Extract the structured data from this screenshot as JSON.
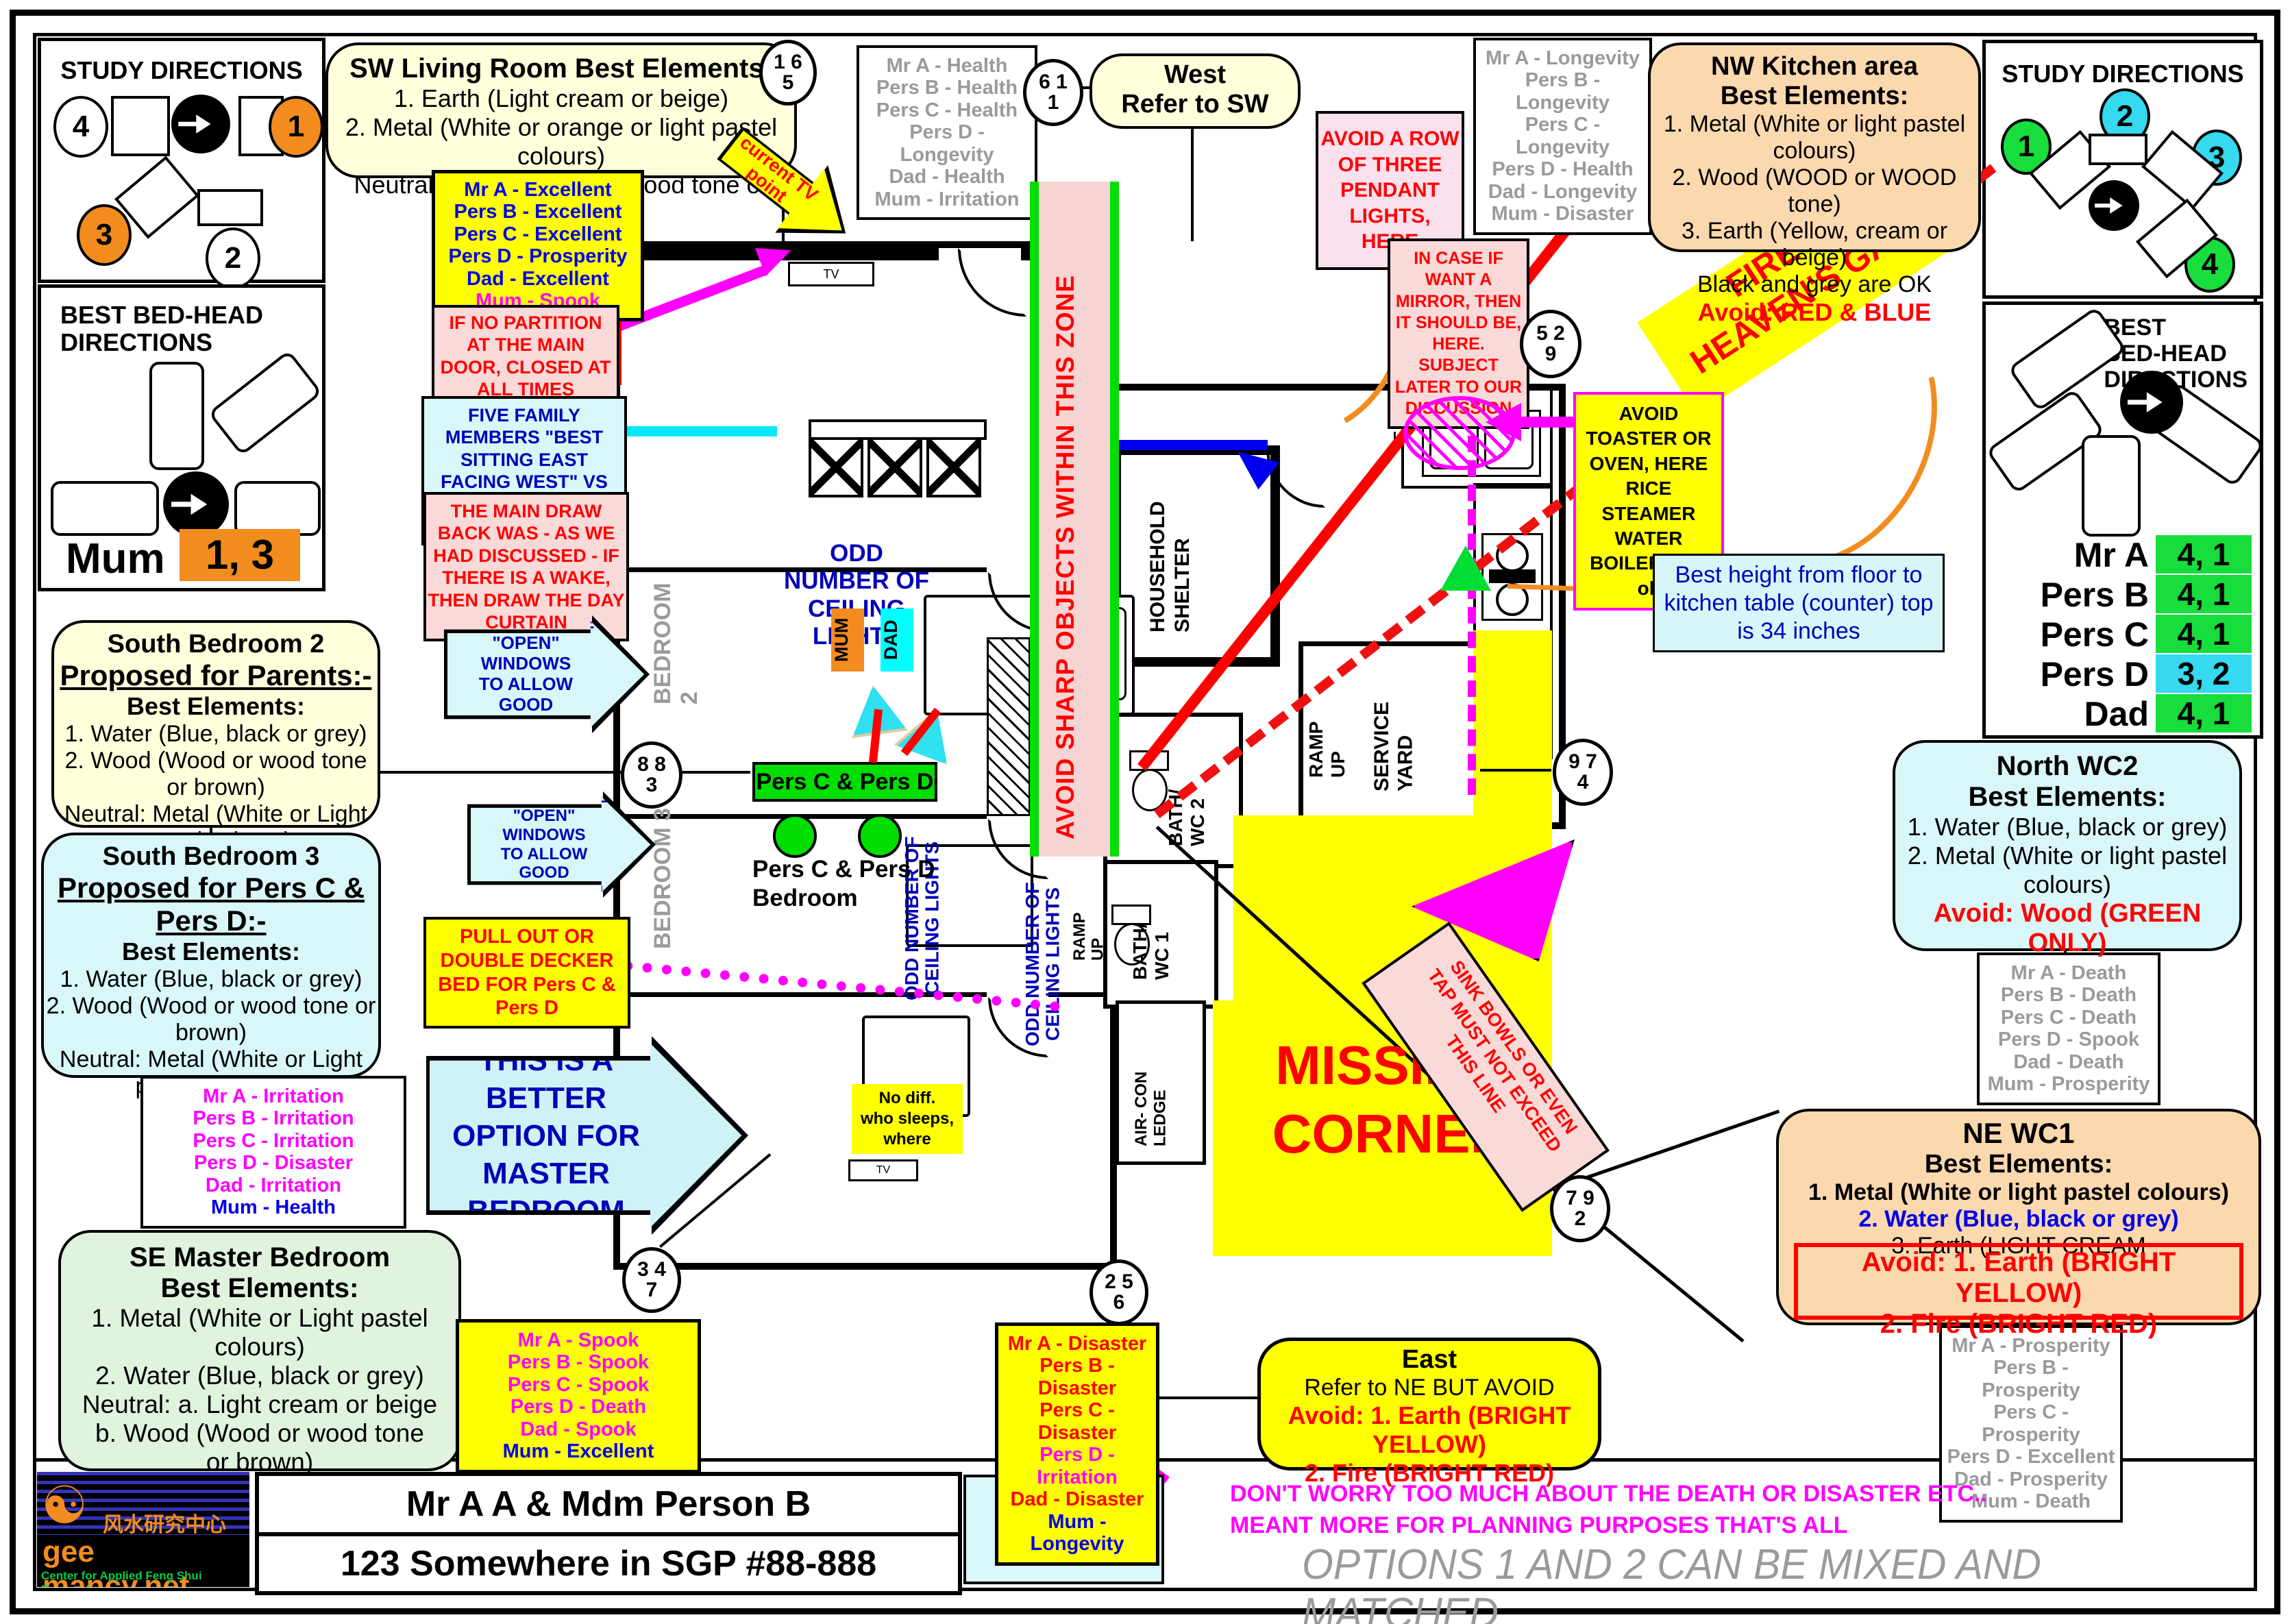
{
  "accent_colors": {
    "cream": "#FFFFDC",
    "peach": "#FBD8AE",
    "cyanbox": "#D9F6F8",
    "green_note": "#DFF3DF",
    "yellow": "#FFFF00",
    "pink": "#FAD9D9",
    "bright_green": "#00DE00",
    "orange": "#F28C1E",
    "cyan": "#35D9F0"
  },
  "panels": {
    "study_left": {
      "title": "STUDY DIRECTIONS",
      "n1": "1",
      "n2": "2",
      "n3": "3",
      "n4": "4"
    },
    "bedhead_left": {
      "title": "BEST BED-HEAD\nDIRECTIONS",
      "person": "Mum",
      "value": "1, 3"
    },
    "study_right": {
      "title": "STUDY DIRECTIONS",
      "n1": "1",
      "n2": "2",
      "n3": "3",
      "n4": "4"
    },
    "bedhead_right": {
      "title": "BEST\nBED-HEAD\nDIRECTIONS",
      "rows": [
        {
          "name": "Mr A",
          "val": "4, 1"
        },
        {
          "name": "Pers B",
          "val": "4, 1"
        },
        {
          "name": "Pers C",
          "val": "4, 1"
        },
        {
          "name": "Pers D",
          "val": "3, 2"
        },
        {
          "name": "Dad",
          "val": "4, 1"
        }
      ]
    }
  },
  "boxes": {
    "sw_living": {
      "title": "SW Living Room Best Elements:",
      "l1": "1. Earth (Light cream or beige)",
      "l2": "2. Metal (White or orange or light pastel colours)",
      "l3": "Neutral: Wood (Wood or wood tone or brown)"
    },
    "west": {
      "l1": "West",
      "l2": "Refer to SW"
    },
    "nw_kitchen": {
      "title": "NW Kitchen area",
      "sub": "Best Elements:",
      "l1": "1. Metal (White or light pastel colours)",
      "l2": "2. Wood (WOOD or WOOD tone)",
      "l3": "3. Earth (Yellow, cream or beige)",
      "l4": "Black and grey are OK",
      "avoid": "Avoid: RED & BLUE"
    },
    "south_b2": {
      "title": "South Bedroom 2",
      "sub": "Proposed for Parents:-",
      "be": "Best Elements:",
      "l1": "1. Water (Blue, black or grey)",
      "l2": "2. Wood (Wood or wood tone or brown)",
      "l3": "Neutral: Metal (White or Light pastel colours)"
    },
    "south_b3": {
      "title": "South Bedroom 3",
      "sub": "Proposed for Pers C & Pers D:-",
      "be": "Best Elements:",
      "l1": "1. Water (Blue, black or grey)",
      "l2": "2. Wood (Wood or wood tone or brown)",
      "l3": "Neutral: Metal (White or Light pastel colours)"
    },
    "se_master": {
      "title": "SE Master Bedroom",
      "sub": "Best Elements:",
      "l1": "1. Metal (White or Light pastel colours)",
      "l2": "2. Water (Blue, black or grey)",
      "l3": "Neutral: a. Light cream or beige b. Wood (Wood or wood tone or brown)"
    },
    "north_wc2": {
      "title": "North WC2",
      "sub": "Best Elements:",
      "l1": "1. Water (Blue, black or grey)",
      "l2": "2. Metal (White or light pastel colours)",
      "avoid": "Avoid: Wood (GREEN ONLY)"
    },
    "ne_wc1": {
      "title": "NE  WC1",
      "sub": "Best Elements:",
      "l1": "1. Metal (White or light pastel colours)",
      "l2": "2. Water (Blue, black or grey)",
      "l3": "3. Earth (LIGHT CREAM",
      "avoid1": "Avoid: 1. Earth (BRIGHT YELLOW)",
      "avoid2": "2. Fire (BRIGHT RED)"
    },
    "east": {
      "title": "East",
      "l1": "Refer to NE BUT AVOID",
      "avoid1": "Avoid: 1. Earth (BRIGHT YELLOW)",
      "avoid2": "2. Fire (BRIGHT RED)"
    }
  },
  "notes": {
    "current_tv": "current TV\npoint",
    "if_no_partition": "IF NO PARTITION AT THE MAIN DOOR, CLOSED AT ALL TIMES",
    "five_family": "FIVE FAMILY MEMBERS \"BEST SITTING EAST FACING WEST\" VS ONLY MUM FACING EAST",
    "main_drawback": "THE MAIN DRAW BACK WAS - AS WE HAD DISCUSSED - IF THERE IS A WAKE, THEN DRAW THE DAY CURTAIN",
    "avoid_row": "AVOID A ROW OF THREE PENDANT LIGHTS, HERE",
    "in_case_mirror": "IN CASE IF WANT A MIRROR, THEN IT SHOULD BE, HERE. SUBJECT LATER TO OUR DISCUSSION",
    "avoid_toaster": "AVOID TOASTER OR OVEN, HERE RICE STEAMER WATER BOILER ARE ok",
    "best_height": "Best height from floor to kitchen table (counter) top is 34 inches",
    "fire_gate": "FIRE AT\nHEAVEN'S GATE",
    "pull_out": "PULL OUT OR DOUBLE DECKER BED FOR Pers C & Pers D",
    "good_qi": "GOOD TO HAVE\n\"OPEN\" WINDOWS\nTO ALLOW GOOD\nQI TO FLOW IN",
    "better_option": "THIS IS A BETTER\nOPTION FOR\nMASTER\nBEDROOM",
    "no_diff": "No diff.\nwho sleeps,\nwhere",
    "avoid_sharp": "AVOID SHARP OBJECTS WITHIN THIS ZONE",
    "missing_corner": "MISSING\nCORNER",
    "sink_bowls": "SINK BOWLS OR EVEN\nTAP MUST NOT EXCEED\nTHIS LINE",
    "odd_lights": "ODD\nNUMBER OF CEILING\nLIGHTS",
    "odd_lights_side": "ODD NUMBER OF CEILING LIGHTS",
    "dont_worry": "DON'T WORRY TOO MUCH ABOUT THE DEATH OR DISASTER ETC.. MEANT MORE FOR PLANNING PURPOSES THAT'S ALL",
    "options_note": "OPTIONS 1 AND 2 CAN BE MIXED AND MATCHED"
  },
  "lists": {
    "living": [
      {
        "t": "Mr A -  Excellent",
        "c": "tblue"
      },
      {
        "t": "Pers B -  Excellent",
        "c": "tblue"
      },
      {
        "t": "Pers C -  Excellent",
        "c": "tblue"
      },
      {
        "t": "Pers D -  Prosperity",
        "c": "tblue"
      },
      {
        "t": "Dad -  Excellent",
        "c": "tblue"
      },
      {
        "t": "Mum -  Spook",
        "c": "tmag"
      }
    ],
    "west": [
      {
        "t": "Mr A -  Health",
        "c": "tgray"
      },
      {
        "t": "Pers B -  Health",
        "c": "tgray"
      },
      {
        "t": "Pers C -  Health",
        "c": "tgray"
      },
      {
        "t": "Pers D -  Longevity",
        "c": "tgray"
      },
      {
        "t": "Dad -  Health",
        "c": "tgray"
      },
      {
        "t": "Mum -  Irritation",
        "c": "tgray"
      }
    ],
    "nw": [
      {
        "t": "Mr A -  Longevity",
        "c": "tgray"
      },
      {
        "t": "Pers B -  Longevity",
        "c": "tgray"
      },
      {
        "t": "Pers C -  Longevity",
        "c": "tgray"
      },
      {
        "t": "Pers D -  Health",
        "c": "tgray"
      },
      {
        "t": "Dad -  Longevity",
        "c": "tgray"
      },
      {
        "t": "Mum -  Disaster",
        "c": "tgray"
      }
    ],
    "se_irr": [
      {
        "t": "Mr A -  Irritation",
        "c": "tmag"
      },
      {
        "t": "Pers B -  Irritation",
        "c": "tmag"
      },
      {
        "t": "Pers C -  Irritation",
        "c": "tmag"
      },
      {
        "t": "Pers D -  Disaster",
        "c": "tmag"
      },
      {
        "t": "Dad -  Irritation",
        "c": "tmag"
      },
      {
        "t": "Mum -  Health",
        "c": "tblue"
      }
    ],
    "se_spook": [
      {
        "t": "Mr A -  Spook",
        "c": "tmag"
      },
      {
        "t": "Pers B -  Spook",
        "c": "tmag"
      },
      {
        "t": "Pers C -  Spook",
        "c": "tmag"
      },
      {
        "t": "Pers D -  Death",
        "c": "tmag"
      },
      {
        "t": "Dad -  Spook",
        "c": "tmag"
      },
      {
        "t": "Mum -  Excellent",
        "c": "tblue"
      }
    ],
    "north": [
      {
        "t": "Mr A -  Death",
        "c": "tgray"
      },
      {
        "t": "Pers B -  Death",
        "c": "tgray"
      },
      {
        "t": "Pers C -  Death",
        "c": "tgray"
      },
      {
        "t": "Pers D -  Spook",
        "c": "tgray"
      },
      {
        "t": "Dad -  Death",
        "c": "tgray"
      },
      {
        "t": "Mum -  Prosperity",
        "c": "tgray"
      }
    ],
    "ne": [
      {
        "t": "Mr A -  Prosperity",
        "c": "tgray"
      },
      {
        "t": "Pers B -  Prosperity",
        "c": "tgray"
      },
      {
        "t": "Pers C -  Prosperity",
        "c": "tgray"
      },
      {
        "t": "Pers D -  Excellent",
        "c": "tgray"
      },
      {
        "t": "Dad -  Prosperity",
        "c": "tgray"
      },
      {
        "t": "Mum -  Death",
        "c": "tgray"
      }
    ],
    "east": [
      {
        "t": "Mr A -  Disaster",
        "c": "tred"
      },
      {
        "t": "Pers B -  Disaster",
        "c": "tred"
      },
      {
        "t": "Pers C -  Disaster",
        "c": "tred"
      },
      {
        "t": "Pers D -  Irritation",
        "c": "tmag"
      },
      {
        "t": "Dad -  Disaster",
        "c": "tred"
      },
      {
        "t": "Mum -  Longevity",
        "c": "tblue"
      }
    ]
  },
  "circles": {
    "c165": {
      "a": "1 6",
      "b": "5"
    },
    "c611": {
      "a": "6 1",
      "b": "1"
    },
    "c529": {
      "a": "5 2",
      "b": "9"
    },
    "c883": {
      "a": "8 8",
      "b": "3"
    },
    "c974": {
      "a": "9 7",
      "b": "4"
    },
    "c347": {
      "a": "3 4",
      "b": "7"
    },
    "c256": {
      "a": "2 5",
      "b": "6"
    },
    "c792": {
      "a": "7 9",
      "b": "2"
    }
  },
  "plan": {
    "bedroom2": "BEDROOM 2",
    "bedroom3": "BEDROOM 3",
    "shelter": "HOUSEHOLD\nSHELTER",
    "bath2": "BATH/\nWC 2",
    "bath1": "BATH/\nWC 1",
    "ramp": "RAMP\nUP",
    "ramp2": "RAMP\nUP",
    "service": "SERVICE\nYARD",
    "aircon": "AIR- CON\nLEDGE",
    "mum": "MUM",
    "dad": "DAD",
    "pers_cd": "Pers C & Pers D",
    "pers_cd_bedroom": "Pers C & Pers D\nBedroom",
    "tv": "TV",
    "f": "F"
  },
  "footer": {
    "name": "Mr A A & Mdm Person B",
    "address": "123 Somewhere in SGP #88-888",
    "best_option": "BEST\nOPTION",
    "site": "gee mancy.net",
    "chinese": "风水研究中心",
    "tagline": "Center for Applied Feng Shui Research",
    "yinyang": "☯"
  }
}
